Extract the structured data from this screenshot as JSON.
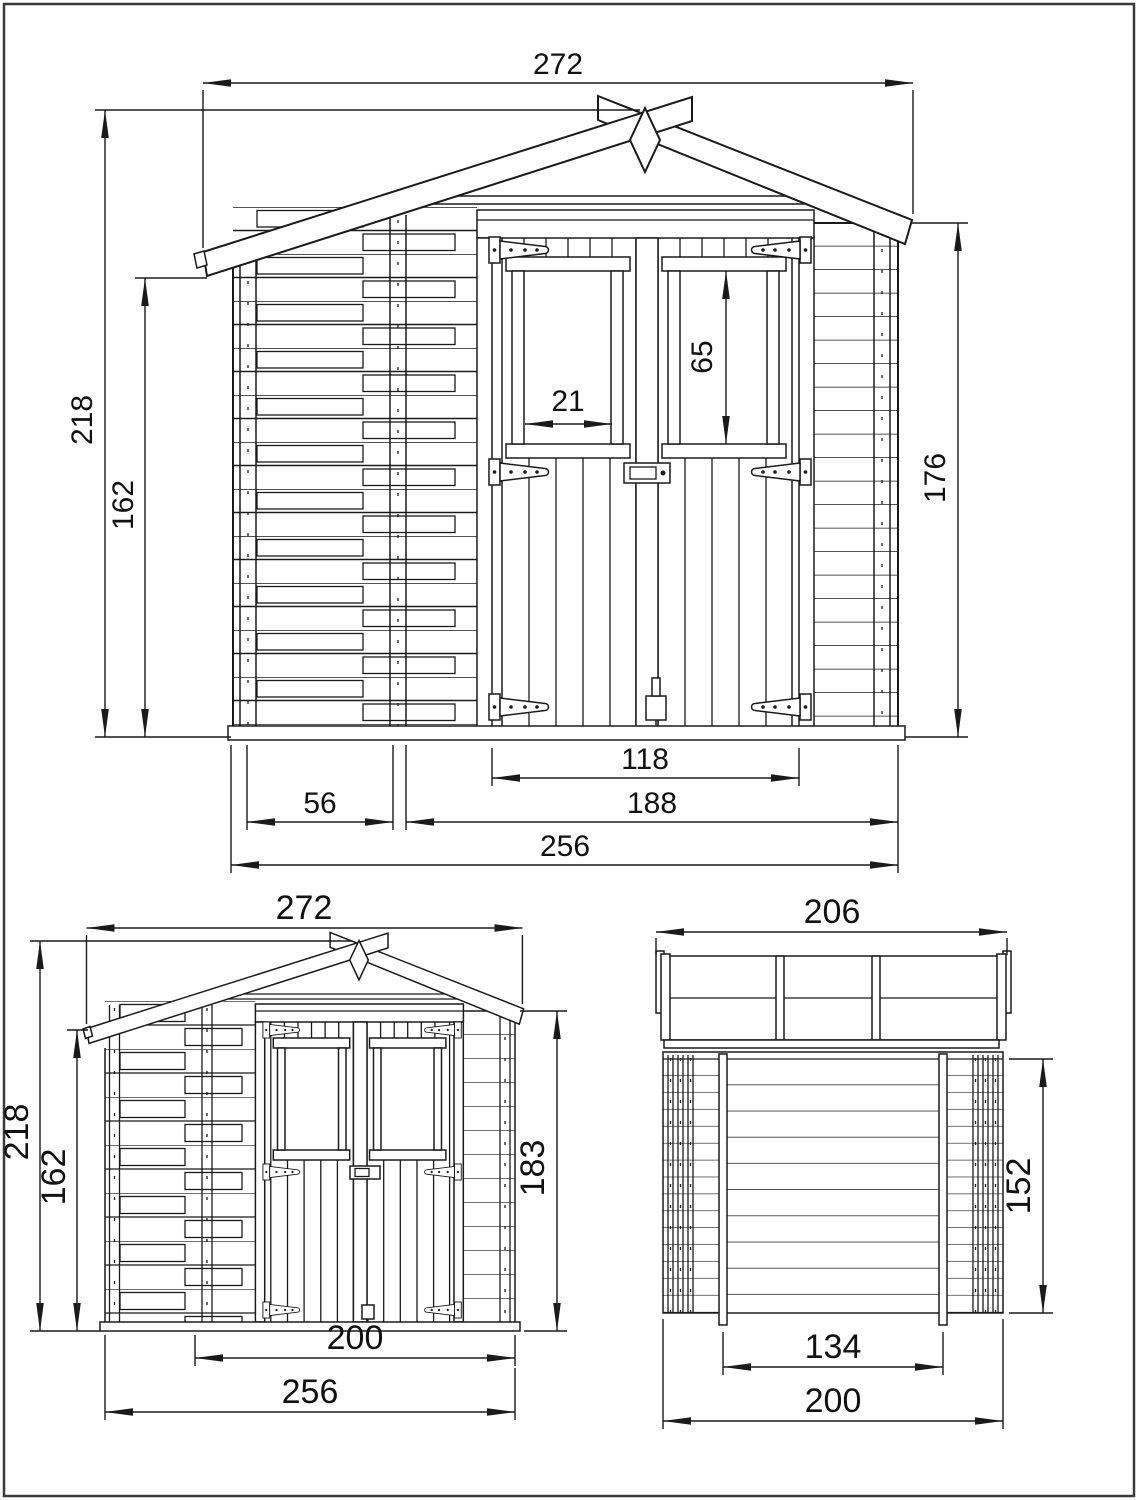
{
  "page": {
    "background": "#ffffff",
    "line_color": "#1a1a1a",
    "border_color": "#3a3a3a"
  },
  "views": {
    "front": {
      "name": "front-elevation",
      "dims": {
        "roof_width": "272",
        "overall_height": "218",
        "side_wall_height": "162",
        "front_wall_height": "176",
        "window_glass_width": "21",
        "window_glass_height": "65",
        "door_width": "118",
        "left_wall_section": "56",
        "front_section_width": "188",
        "total_width": "256"
      }
    },
    "front_small": {
      "name": "front-elevation-overview",
      "dims": {
        "roof_width": "272",
        "overall_height": "218",
        "side_wall_height": "162",
        "eaves_height": "183",
        "door_section_width": "200",
        "total_width": "256"
      }
    },
    "rear": {
      "name": "rear-elevation",
      "dims": {
        "roof_width": "206",
        "wall_height": "152",
        "inner_width": "134",
        "total_width": "200"
      }
    }
  }
}
